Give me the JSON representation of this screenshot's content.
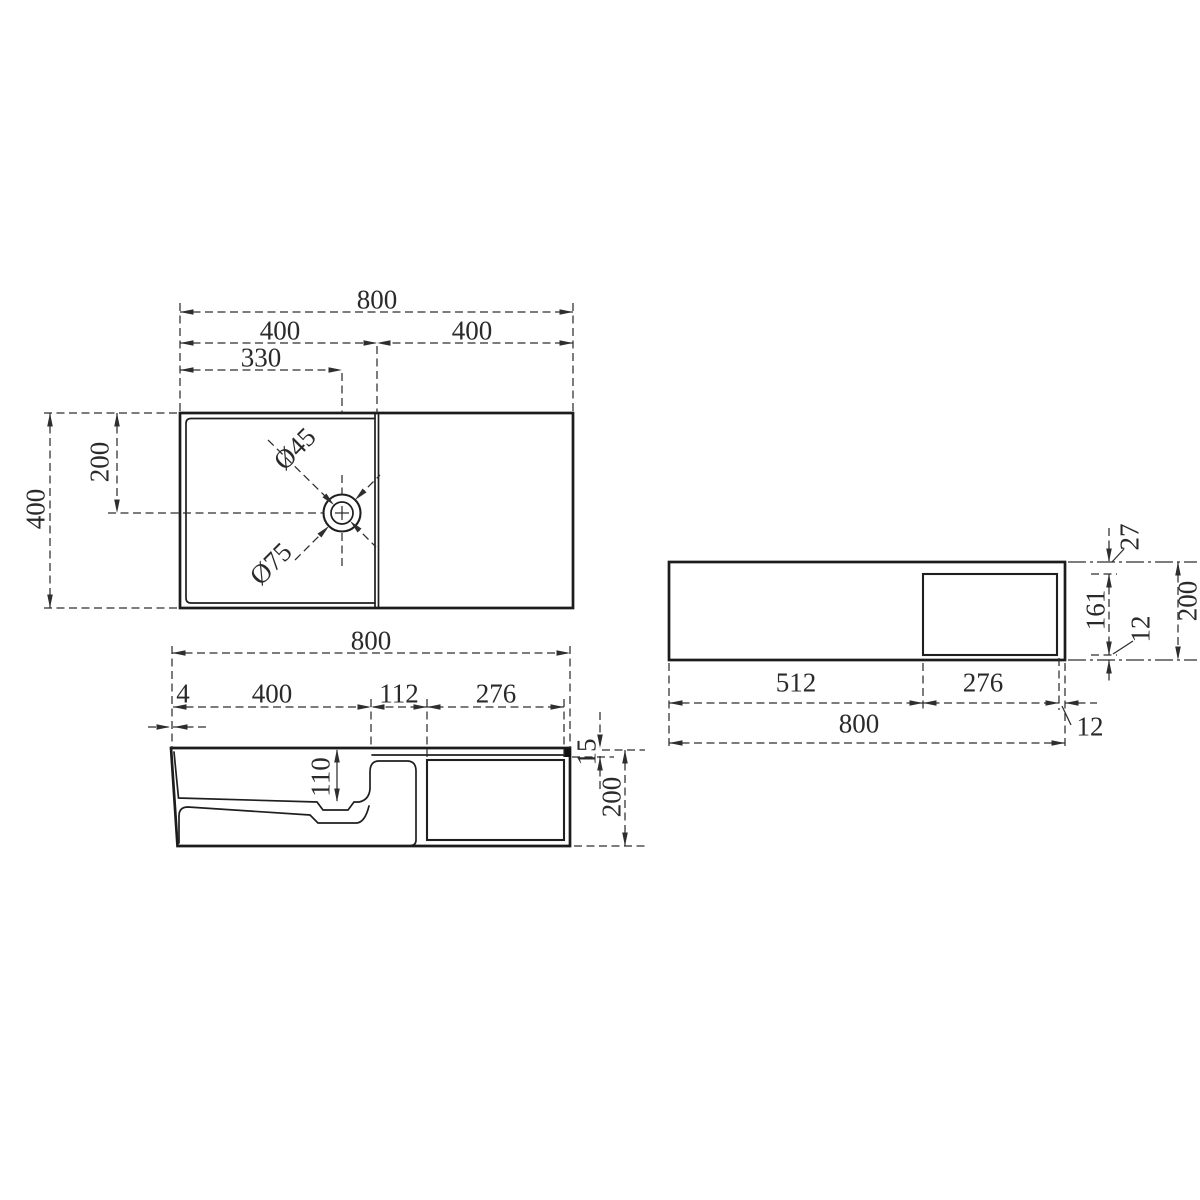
{
  "drawing": {
    "plan_view": {
      "width_total": "800",
      "width_left_half": "400",
      "width_right_half": "400",
      "drain_offset_x": "330",
      "height_total": "400",
      "drain_offset_y": "200",
      "drain_diameter_inner": "Ø45",
      "drain_diameter_outer": "Ø75"
    },
    "front_section_view": {
      "width_total": "800",
      "front_lip": "4",
      "basin_width": "400",
      "step_width": "112",
      "niche_width": "276",
      "basin_depth": "110",
      "top_thickness": "15",
      "height_total": "200"
    },
    "rear_elevation_view": {
      "left_width": "512",
      "niche_width": "276",
      "width_total": "800",
      "side_wall": "12",
      "niche_top_offset": "27",
      "niche_height": "161",
      "niche_bottom_offset": "12",
      "height_total": "200"
    },
    "line_color": "#1c1c1c",
    "dim_color": "#2a2a2a",
    "background": "#ffffff"
  }
}
